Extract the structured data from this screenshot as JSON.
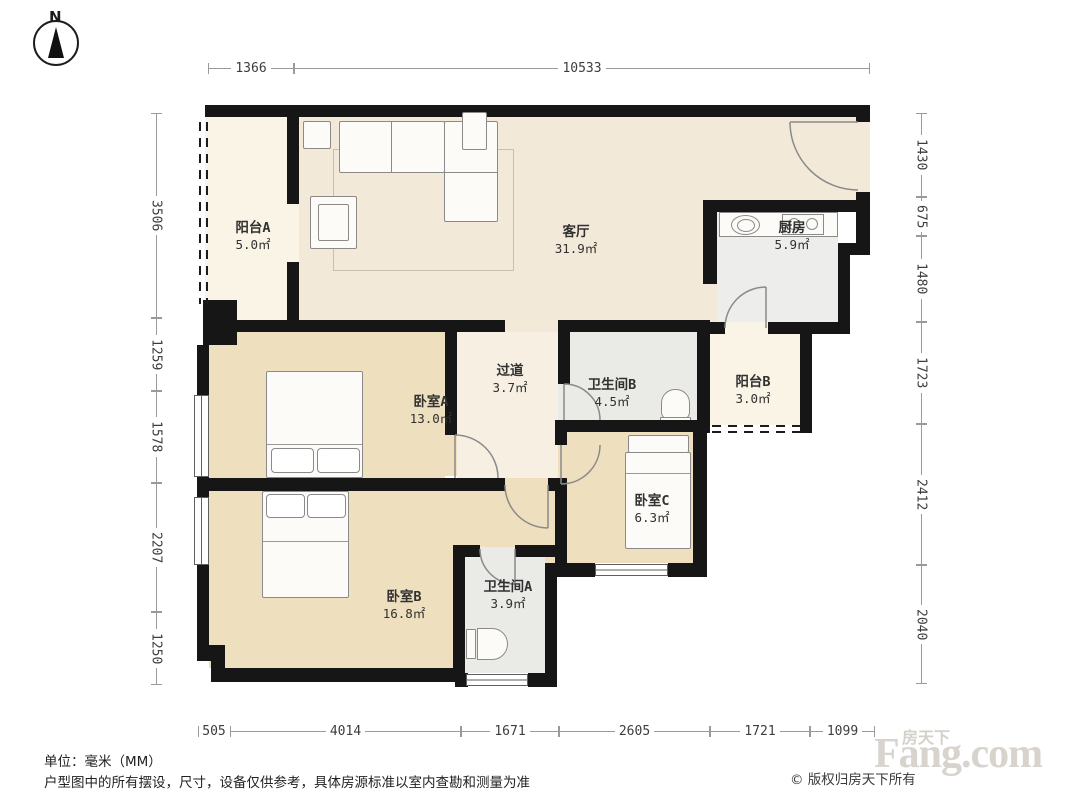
{
  "compass": {
    "label": "N"
  },
  "dimensions": {
    "top": [
      "1366",
      "10533"
    ],
    "left": [
      "3506",
      "1259",
      "1578",
      "2207",
      "1250"
    ],
    "right": [
      "1430",
      "675",
      "1480",
      "1723",
      "2412",
      "2040"
    ],
    "bottom": [
      "505",
      "4014",
      "1671",
      "2605",
      "1721",
      "1099"
    ]
  },
  "rooms": [
    {
      "name": "阳台A",
      "area": "5.0㎡"
    },
    {
      "name": "客厅",
      "area": "31.9㎡"
    },
    {
      "name": "厨房",
      "area": "5.9㎡"
    },
    {
      "name": "过道",
      "area": "3.7㎡"
    },
    {
      "name": "卫生间B",
      "area": "4.5㎡"
    },
    {
      "name": "阳台B",
      "area": "3.0㎡"
    },
    {
      "name": "卧室A",
      "area": "13.0㎡"
    },
    {
      "name": "卧室C",
      "area": "6.3㎡"
    },
    {
      "name": "卧室B",
      "area": "16.8㎡"
    },
    {
      "name": "卫生间A",
      "area": "3.9㎡"
    }
  ],
  "footer": {
    "unit": "单位：毫米（MM）",
    "disclaimer": "户型图中的所有摆设，尺寸，设备仅供参考，具体房源标准以室内查勘和测量为准"
  },
  "watermark": {
    "brand_cn": "房天下",
    "brand_en": "Fang.com",
    "copyright": "© 版权归房天下所有"
  },
  "colors": {
    "wall": "#161616",
    "living": "#f3e9d8",
    "corridor": "#f6efe2",
    "bedroom": "#eedfbe",
    "bathroom": "#eaeae6",
    "kitchen": "#ededeb",
    "balcony": "#faf4e6",
    "watermark": "#d8d4cd"
  }
}
